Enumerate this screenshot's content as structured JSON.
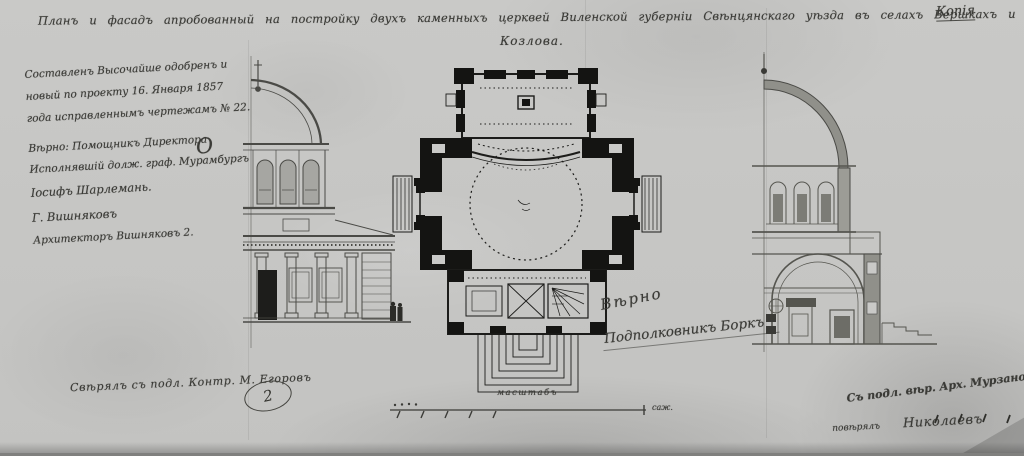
{
  "document": {
    "copy_stamp": "Копія",
    "title": {
      "line1": "Планъ и фасадъ апробованный на постройку двухъ каменныхъ церквей Виленской губерніи Свѣнцянскаго уѣзда въ селахъ Вершкахъ и Старомъ",
      "line2": "Козлова."
    },
    "approval_note": {
      "lines": [
        "Составленъ Высочайше одобренъ и",
        "новый по проекту 16. Января 1857",
        "года исправленнымъ чертежамъ № 22.",
        "Вѣрно: Помощникъ Директора",
        "Исполнявшій долж. граф. Мурамбургъ",
        "Іосифъ Шарлемань.",
        "Г. Вишняковъ",
        "Архитекторъ Вишняковъ 2."
      ],
      "flourish": "О"
    },
    "verification": {
      "line1": "Вѣрно",
      "line2": "Подполковникъ Боркъ"
    },
    "scale": {
      "caption": "масштабъ",
      "unit_label": "саж."
    },
    "bottom_left": {
      "note": "Свѣрялъ съ подл. Контр. М. Егоровъ",
      "sheet_number": "2"
    },
    "bottom_right": {
      "line1": "Съ подл. вѣр. Арх. Мурзановъ",
      "line2_left": "повѣрялъ",
      "line2_right": "Николаевъ"
    }
  },
  "drawings": {
    "left": "half-elevation-of-church-facade",
    "center": "church-floor-plan",
    "right": "half-cross-section-of-church"
  },
  "colors": {
    "paper": "#c7c7c5",
    "ink": "#2f2f2b",
    "wall_poche": "#141412"
  }
}
